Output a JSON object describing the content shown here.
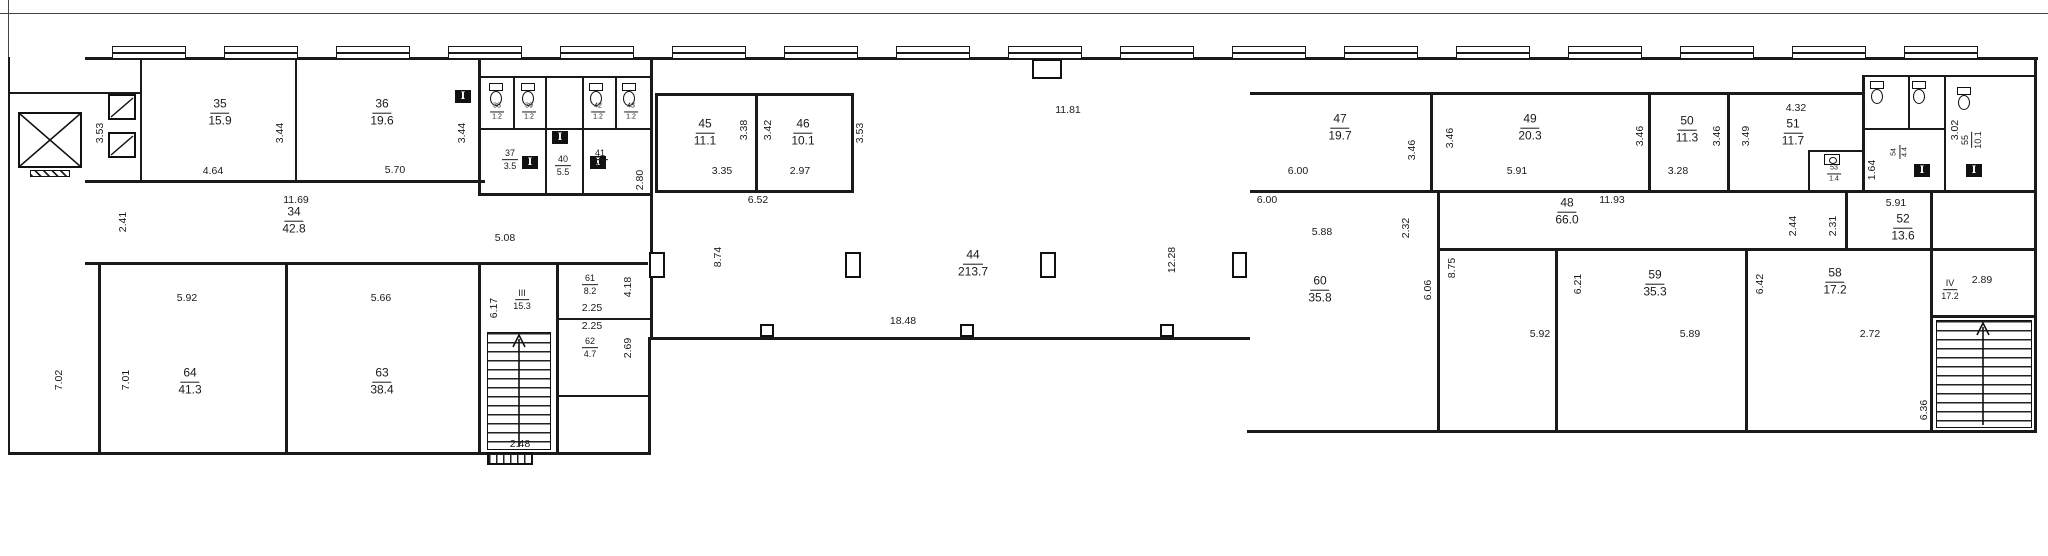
{
  "document": {
    "kind": "architectural floor plan",
    "units": "m / m2"
  },
  "colors": {
    "wall": "#1a1a1a",
    "background": "#ffffff",
    "text": "#1a1a1a"
  },
  "icons": {
    "door_marker_glyph": "I",
    "wc_icon": "toilet",
    "elevator_icon": "crossed-box"
  },
  "rooms": [
    {
      "number": "35",
      "area": "15.9",
      "x": 220,
      "y": 113
    },
    {
      "number": "36",
      "area": "19.6",
      "x": 382,
      "y": 113
    },
    {
      "number": "34",
      "area": "42.8",
      "x": 294,
      "y": 221
    },
    {
      "number": "37",
      "area": "3.5",
      "x": 510,
      "y": 160,
      "size": "small"
    },
    {
      "number": "40",
      "area": "5.5",
      "x": 563,
      "y": 166,
      "size": "small"
    },
    {
      "number": "41",
      "area": "3.4",
      "x": 600,
      "y": 160,
      "size": "small"
    },
    {
      "number": "38",
      "area": "1.2",
      "x": 497,
      "y": 112,
      "size": "xsmall"
    },
    {
      "number": "39",
      "area": "1.2",
      "x": 529,
      "y": 112,
      "size": "xsmall"
    },
    {
      "number": "42",
      "area": "1.2",
      "x": 598,
      "y": 112,
      "size": "xsmall"
    },
    {
      "number": "43",
      "area": "1.2",
      "x": 631,
      "y": 112,
      "size": "xsmall"
    },
    {
      "number": "45",
      "area": "11.1",
      "x": 705,
      "y": 133
    },
    {
      "number": "46",
      "area": "10.1",
      "x": 803,
      "y": 133
    },
    {
      "number": "44",
      "area": "213.7",
      "x": 973,
      "y": 264
    },
    {
      "number": "47",
      "area": "19.7",
      "x": 1340,
      "y": 128
    },
    {
      "number": "49",
      "area": "20.3",
      "x": 1530,
      "y": 128
    },
    {
      "number": "50",
      "area": "11.3",
      "x": 1687,
      "y": 130
    },
    {
      "number": "51",
      "area": "11.7",
      "x": 1793,
      "y": 133
    },
    {
      "number": "48",
      "area": "66.0",
      "x": 1567,
      "y": 212
    },
    {
      "number": "52",
      "area": "13.6",
      "x": 1903,
      "y": 228
    },
    {
      "number": "53",
      "area": "1.4",
      "x": 1834,
      "y": 174,
      "size": "xsmall"
    },
    {
      "number": "54",
      "area": "4.4",
      "x": 1900,
      "y": 152,
      "size": "xsmall",
      "rot": true
    },
    {
      "number": "55",
      "area": "10.1",
      "x": 1972,
      "y": 140,
      "size": "small",
      "rot": true
    },
    {
      "number": "60",
      "area": "35.8",
      "x": 1320,
      "y": 290
    },
    {
      "number": "59",
      "area": "35.3",
      "x": 1655,
      "y": 284
    },
    {
      "number": "58",
      "area": "17.2",
      "x": 1835,
      "y": 282
    },
    {
      "number": "61",
      "area": "8.2",
      "x": 590,
      "y": 285,
      "size": "small"
    },
    {
      "number": "62",
      "area": "4.7",
      "x": 590,
      "y": 348,
      "size": "small"
    },
    {
      "number": "63",
      "area": "38.4",
      "x": 382,
      "y": 382
    },
    {
      "number": "64",
      "area": "41.3",
      "x": 190,
      "y": 382
    },
    {
      "number": "III",
      "area": "15.3",
      "x": 522,
      "y": 300,
      "size": "small"
    },
    {
      "number": "IV",
      "area": "17.2",
      "x": 1950,
      "y": 290,
      "size": "small"
    }
  ],
  "dimensions": [
    {
      "text": "3.53",
      "x": 100,
      "y": 133,
      "rot": true
    },
    {
      "text": "3.44",
      "x": 280,
      "y": 133,
      "rot": true
    },
    {
      "text": "3.44",
      "x": 462,
      "y": 133,
      "rot": true
    },
    {
      "text": "4.64",
      "x": 213,
      "y": 171
    },
    {
      "text": "5.70",
      "x": 395,
      "y": 170
    },
    {
      "text": "11.69",
      "x": 296,
      "y": 200
    },
    {
      "text": "2.41",
      "x": 123,
      "y": 222,
      "rot": true
    },
    {
      "text": "2.80",
      "x": 640,
      "y": 180,
      "rot": true
    },
    {
      "text": "5.92",
      "x": 187,
      "y": 298
    },
    {
      "text": "5.66",
      "x": 381,
      "y": 298
    },
    {
      "text": "7.02",
      "x": 59,
      "y": 380,
      "rot": true
    },
    {
      "text": "7.01",
      "x": 126,
      "y": 380,
      "rot": true
    },
    {
      "text": "5.08",
      "x": 505,
      "y": 238
    },
    {
      "text": "6.17",
      "x": 494,
      "y": 308,
      "rot": true
    },
    {
      "text": "4.18",
      "x": 628,
      "y": 287,
      "rot": true
    },
    {
      "text": "2.25",
      "x": 592,
      "y": 308
    },
    {
      "text": "2.25",
      "x": 592,
      "y": 326
    },
    {
      "text": "2.69",
      "x": 628,
      "y": 348,
      "rot": true
    },
    {
      "text": "2.48",
      "x": 520,
      "y": 444
    },
    {
      "text": "3.35",
      "x": 722,
      "y": 171
    },
    {
      "text": "2.97",
      "x": 800,
      "y": 171
    },
    {
      "text": "6.52",
      "x": 758,
      "y": 200
    },
    {
      "text": "3.38",
      "x": 744,
      "y": 130,
      "rot": true
    },
    {
      "text": "3.42",
      "x": 768,
      "y": 130,
      "rot": true
    },
    {
      "text": "3.53",
      "x": 860,
      "y": 133,
      "rot": true
    },
    {
      "text": "11.81",
      "x": 1068,
      "y": 110
    },
    {
      "text": "8.74",
      "x": 718,
      "y": 257,
      "rot": true
    },
    {
      "text": "12.28",
      "x": 1172,
      "y": 260,
      "rot": true
    },
    {
      "text": "18.48",
      "x": 903,
      "y": 321
    },
    {
      "text": "6.00",
      "x": 1298,
      "y": 171
    },
    {
      "text": "6.00",
      "x": 1267,
      "y": 200
    },
    {
      "text": "3.46",
      "x": 1412,
      "y": 150,
      "rot": true
    },
    {
      "text": "3.46",
      "x": 1450,
      "y": 138,
      "rot": true
    },
    {
      "text": "5.91",
      "x": 1517,
      "y": 171
    },
    {
      "text": "11.93",
      "x": 1612,
      "y": 200
    },
    {
      "text": "2.32",
      "x": 1406,
      "y": 228,
      "rot": true
    },
    {
      "text": "3.46",
      "x": 1640,
      "y": 136,
      "rot": true
    },
    {
      "text": "3.28",
      "x": 1678,
      "y": 171
    },
    {
      "text": "3.46",
      "x": 1717,
      "y": 136,
      "rot": true
    },
    {
      "text": "3.49",
      "x": 1746,
      "y": 136,
      "rot": true
    },
    {
      "text": "4.32",
      "x": 1796,
      "y": 108
    },
    {
      "text": "5.88",
      "x": 1322,
      "y": 232
    },
    {
      "text": "6.06",
      "x": 1428,
      "y": 290,
      "rot": true
    },
    {
      "text": "8.75",
      "x": 1452,
      "y": 268,
      "rot": true
    },
    {
      "text": "5.92",
      "x": 1540,
      "y": 334
    },
    {
      "text": "6.21",
      "x": 1578,
      "y": 284,
      "rot": true
    },
    {
      "text": "5.89",
      "x": 1690,
      "y": 334
    },
    {
      "text": "6.42",
      "x": 1760,
      "y": 284,
      "rot": true
    },
    {
      "text": "2.72",
      "x": 1870,
      "y": 334
    },
    {
      "text": "2.44",
      "x": 1793,
      "y": 226,
      "rot": true
    },
    {
      "text": "2.31",
      "x": 1833,
      "y": 226,
      "rot": true
    },
    {
      "text": "5.91",
      "x": 1896,
      "y": 203
    },
    {
      "text": "1.64",
      "x": 1872,
      "y": 170,
      "rot": true
    },
    {
      "text": "3.02",
      "x": 1955,
      "y": 130,
      "rot": true
    },
    {
      "text": "2.89",
      "x": 1982,
      "y": 280
    },
    {
      "text": "6.36",
      "x": 1924,
      "y": 410,
      "rot": true
    }
  ]
}
